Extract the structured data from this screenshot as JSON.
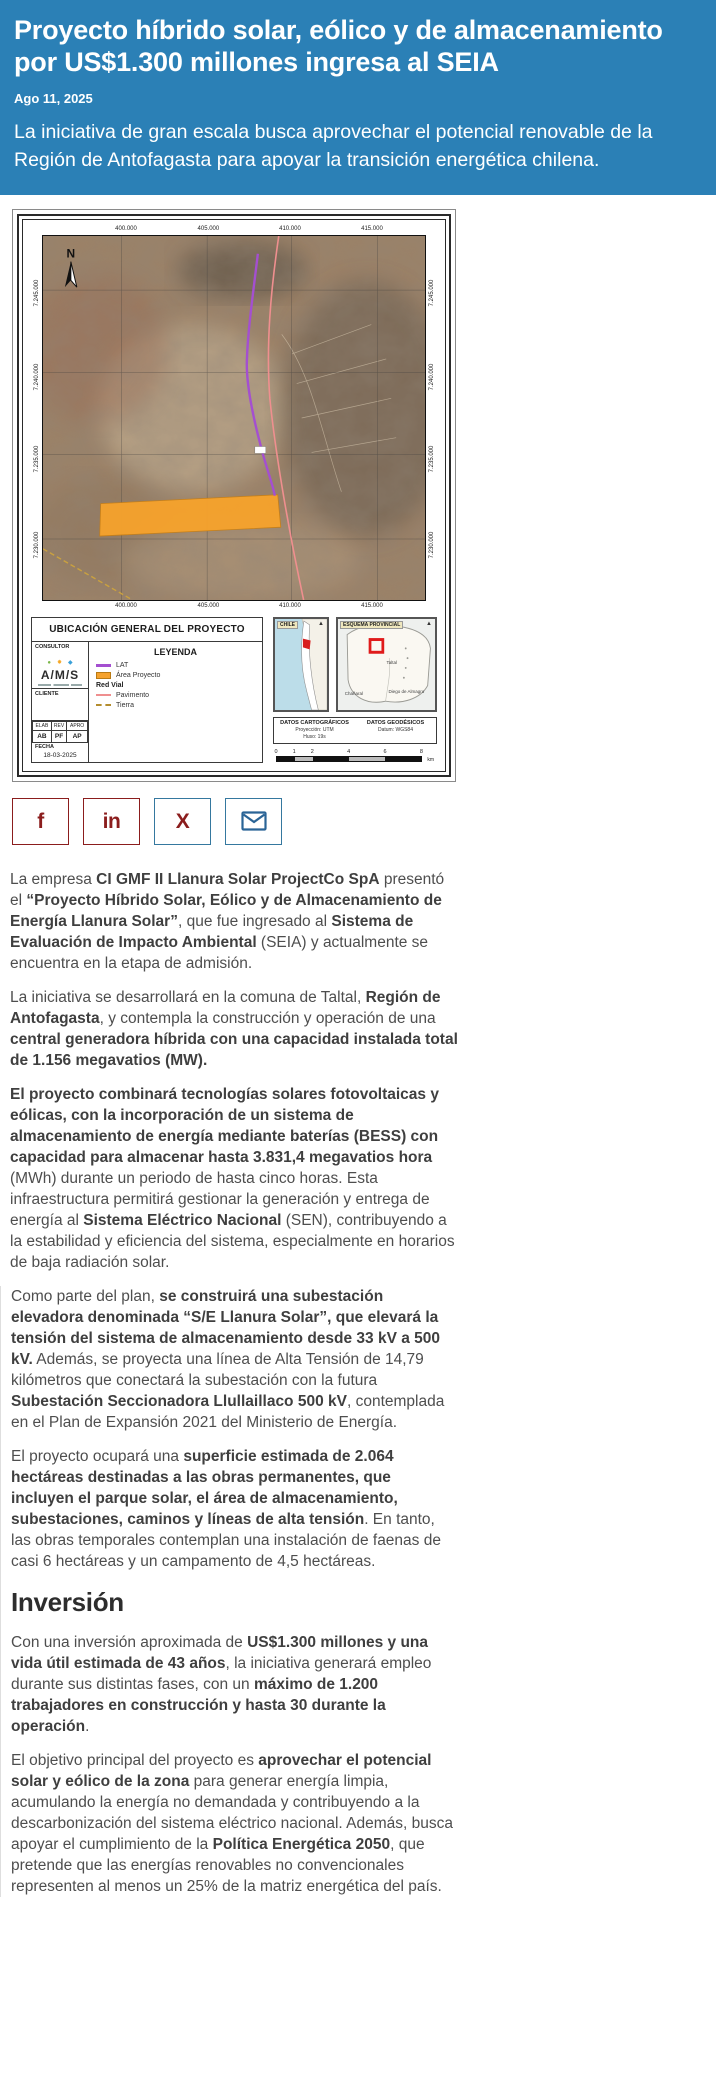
{
  "header": {
    "title": "Proyecto híbrido solar, eólico y de almacenamiento por US$1.300 millones ingresa al SEIA",
    "date": "Ago 11, 2025",
    "deck": "La iniciativa de gran escala busca aprovechar el potencial renovable de la Región de Antofagasta para apoyar la transición energética chilena.",
    "bg_color": "#2b80b6"
  },
  "map": {
    "title": "UBICACIÓN GENERAL DEL PROYECTO",
    "north_label": "N",
    "coords": {
      "top": [
        "400.000",
        "405.000",
        "410.000",
        "415.000"
      ],
      "bottom": [
        "400.000",
        "405.000",
        "410.000",
        "415.000"
      ],
      "left": [
        "7.245.000",
        "7.240.000",
        "7.235.000",
        "7.230.000"
      ],
      "right": [
        "7.245.000",
        "7.240.000",
        "7.235.000",
        "7.230.000"
      ]
    },
    "consultor": {
      "label": "CONSULTOR",
      "logo": "A/M/S"
    },
    "cliente_label": "CLIENTE",
    "legend": {
      "title": "LEYENDA",
      "items": [
        {
          "label": "LAT",
          "type": "line",
          "color": "#a44fd0"
        },
        {
          "label": "Área Proyecto",
          "type": "fill",
          "color": "#f5a22d"
        },
        {
          "label": "Red Vial",
          "type": "group"
        },
        {
          "label": "Pavimento",
          "type": "thin",
          "color": "#ef8f8f"
        },
        {
          "label": "Tierra",
          "type": "dash",
          "color": "#b48d2e"
        }
      ]
    },
    "approval": {
      "headers": [
        "ELAB",
        "REV",
        "APRO"
      ],
      "values": [
        "AB",
        "PF",
        "AP"
      ],
      "fecha_label": "FECHA",
      "fecha_value": "18-03-2025"
    },
    "inset_chile": {
      "label": "CHILE"
    },
    "inset_prov": {
      "label": "ESQUEMA PROVINCIAL",
      "places": [
        "Taltal",
        "Chañaral",
        "Diego de Almagro"
      ]
    },
    "datos_cart": {
      "title": "DATOS CARTOGRÁFICOS",
      "lines": [
        "Proyección: UTM",
        "Huso: 19s"
      ]
    },
    "datos_geo": {
      "title": "DATOS GEODÉSICOS",
      "lines": [
        "Datum: WGS84"
      ]
    },
    "scale": {
      "ticks": [
        "0",
        "1",
        "2",
        "4",
        "6",
        "8"
      ],
      "unit": "km"
    }
  },
  "share": {
    "buttons": [
      {
        "id": "facebook",
        "glyph": "f",
        "style": "red",
        "color": "#8b1d1d"
      },
      {
        "id": "linkedin",
        "glyph": "in",
        "style": "red",
        "color": "#8b1d1d"
      },
      {
        "id": "x",
        "glyph": "X",
        "style": "blue",
        "color": "#8b1d1d"
      },
      {
        "id": "email",
        "glyph": "envelope",
        "style": "blue",
        "color": "#2a6496"
      }
    ]
  },
  "article": {
    "sections": [
      {
        "type": "p",
        "group": "lead",
        "runs": [
          {
            "t": "La empresa ",
            "b": false
          },
          {
            "t": "CI GMF II Llanura Solar ProjectCo SpA",
            "b": true
          },
          {
            "t": " presentó el ",
            "b": false
          },
          {
            "t": "“Proyecto Híbrido Solar, Eólico y de Almacenamiento de Energía Llanura Solar”",
            "b": true
          },
          {
            "t": ", que fue ingresado al ",
            "b": false
          },
          {
            "t": "Sistema de Evaluación de Impacto Ambiental",
            "b": true
          },
          {
            "t": " (SEIA) y actualmente se encuentra en la etapa de admisión.",
            "b": false
          }
        ]
      },
      {
        "type": "p",
        "group": "lead",
        "runs": [
          {
            "t": "La iniciativa se desarrollará en la comuna de Taltal, ",
            "b": false
          },
          {
            "t": "Región de Antofagasta",
            "b": true
          },
          {
            "t": ", y contempla la construcción y operación de una ",
            "b": false
          },
          {
            "t": "central generadora híbrida con una capacidad instalada total de 1.156 megavatios (MW).",
            "b": true
          }
        ]
      },
      {
        "type": "p",
        "group": "lead",
        "runs": [
          {
            "t": "El proyecto combinará tecnologías solares fotovoltaicas y eólicas, con la incorporación de un sistema de almacenamiento de energía mediante baterías (BESS) con capacidad para almacenar hasta 3.831,4 megavatios hora",
            "b": true
          },
          {
            "t": " (MWh) durante un periodo de hasta cinco horas. Esta infraestructura permitirá gestionar la generación y entrega de energía al ",
            "b": false
          },
          {
            "t": "Sistema Eléctrico Nacional",
            "b": true
          },
          {
            "t": " (SEN), contribuyendo a la estabilidad y eficiencia del sistema, especialmente en horarios de baja radiación solar.",
            "b": false
          }
        ]
      },
      {
        "type": "p",
        "group": "quoted",
        "runs": [
          {
            "t": "Como parte del plan, ",
            "b": false
          },
          {
            "t": "se construirá una subestación elevadora denominada “S/E Llanura Solar”, que elevará la tensión del sistema de almacenamiento desde 33 kV a 500 kV.",
            "b": true
          },
          {
            "t": " Además, se proyecta una línea de Alta Tensión de 14,79 kilómetros que conectará la subestación con la futura ",
            "b": false
          },
          {
            "t": "Subestación Seccionadora Llullaillaco 500 kV",
            "b": true
          },
          {
            "t": ", contemplada en el Plan de Expansión 2021 del Ministerio de Energía.",
            "b": false
          }
        ]
      },
      {
        "type": "p",
        "group": "quoted",
        "runs": [
          {
            "t": "El proyecto ocupará una ",
            "b": false
          },
          {
            "t": "superficie estimada de 2.064 hectáreas destinadas a las obras permanentes, que incluyen el parque solar, el área de almacenamiento, subestaciones, caminos y líneas de alta tensión",
            "b": true
          },
          {
            "t": ". En tanto, las obras temporales contemplan una instalación de faenas de casi 6 hectáreas y un campamento de 4,5 hectáreas.",
            "b": false
          }
        ]
      },
      {
        "type": "h2",
        "group": "quoted",
        "text": "Inversión"
      },
      {
        "type": "p",
        "group": "quoted",
        "runs": [
          {
            "t": "Con una inversión aproximada de ",
            "b": false
          },
          {
            "t": "US$1.300 millones y una vida útil estimada de 43 años",
            "b": true
          },
          {
            "t": ", la iniciativa generará empleo durante sus distintas fases, con un ",
            "b": false
          },
          {
            "t": "máximo de 1.200 trabajadores en construcción y hasta 30 durante la operación",
            "b": true
          },
          {
            "t": ".",
            "b": false
          }
        ]
      },
      {
        "type": "p",
        "group": "quoted",
        "runs": [
          {
            "t": "El objetivo principal del proyecto es ",
            "b": false
          },
          {
            "t": "aprovechar el potencial solar y eólico de la zona",
            "b": true
          },
          {
            "t": " para generar energía limpia, acumulando la energía no demandada y contribuyendo a la descarbonización del sistema eléctrico nacional. Además, busca apoyar el cumplimiento de la ",
            "b": false
          },
          {
            "t": "Política Energética 2050",
            "b": true
          },
          {
            "t": ", que pretende que las energías renovables no convencionales representen al menos un 25% de la matriz energética del país.",
            "b": false
          }
        ]
      }
    ]
  }
}
